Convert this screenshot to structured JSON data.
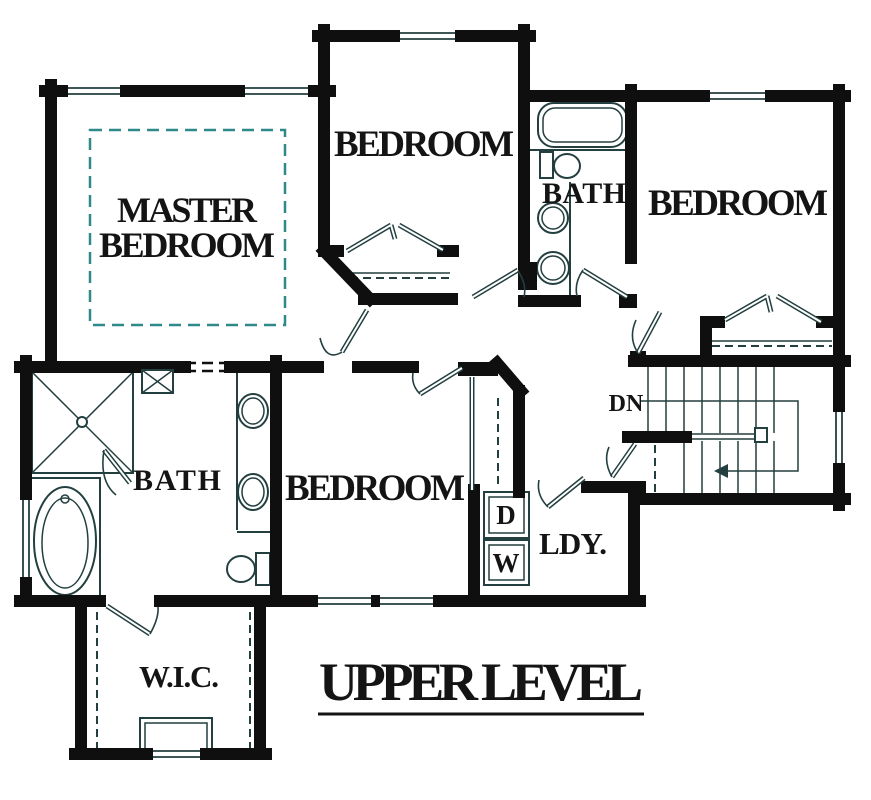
{
  "title": {
    "label": "UPPER LEVEL"
  },
  "rooms": {
    "master_bedroom": {
      "label_line1": "MASTER",
      "label_line2": "BEDROOM"
    },
    "bedroom_top": {
      "label": "BEDROOM"
    },
    "bedroom_right": {
      "label": "BEDROOM"
    },
    "bedroom_bottom": {
      "label": "BEDROOM"
    },
    "bath_hall": {
      "label": "BATH"
    },
    "bath_master": {
      "label": "BATH"
    },
    "closet_wic": {
      "label": "W.I.C."
    },
    "laundry": {
      "label": "LDY.",
      "dryer_label": "D",
      "washer_label": "W"
    },
    "stairs": {
      "down_label": "DN"
    }
  },
  "colors": {
    "wall": "#0f0f0f",
    "fixture": "#233f3f",
    "dash_accent": "#2e8a8a",
    "text": "#141414",
    "background": "#ffffff"
  }
}
